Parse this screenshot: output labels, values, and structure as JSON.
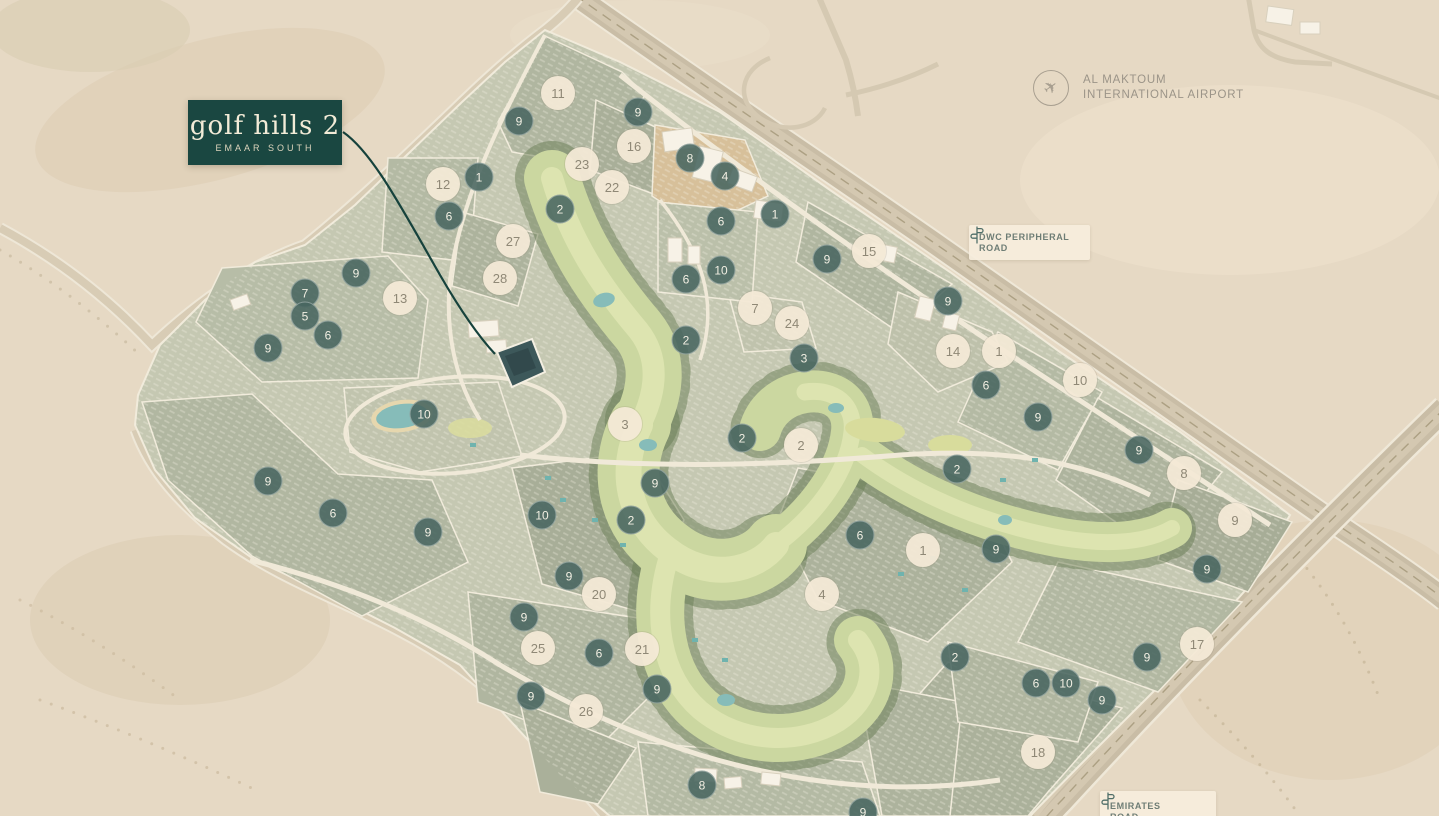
{
  "project_badge": {
    "title": "golf hills 2",
    "subtitle": "EMAAR SOUTH"
  },
  "map_labels": {
    "airport": {
      "icon": "airplane-icon",
      "line1": "AL MAKTOUM",
      "line2": "INTERNATIONAL AIRPORT"
    },
    "dwc_road": {
      "icon": "signpost-icon",
      "line1": "DWC PERIPHERAL",
      "line2": "ROAD"
    },
    "emirates_road": {
      "icon": "signpost-icon",
      "line1": "EMIRATES",
      "line2": "ROAD"
    }
  },
  "colors": {
    "badge_bg": "#1a4741",
    "badge_text": "#f2ebd7",
    "marker_dark_bg": "#486560",
    "marker_dark_text": "#f2efe3",
    "marker_light_bg": "#f3e9d6",
    "marker_light_text": "#8f8876",
    "highlight_plot": "#3d585a",
    "leader_line": "#16423c",
    "desert": "#e6d9c4",
    "development": "#c5c8b2",
    "golf_green": "#cbd7a0",
    "water": "#86bcb9",
    "road": "#c9bda6"
  },
  "markers": {
    "items": [
      {
        "n": "9",
        "x": 519,
        "y": 121,
        "variant": "dark"
      },
      {
        "n": "9",
        "x": 638,
        "y": 112,
        "variant": "dark"
      },
      {
        "n": "8",
        "x": 690,
        "y": 158,
        "variant": "dark"
      },
      {
        "n": "4",
        "x": 725,
        "y": 176,
        "variant": "dark"
      },
      {
        "n": "1",
        "x": 479,
        "y": 177,
        "variant": "dark"
      },
      {
        "n": "2",
        "x": 560,
        "y": 209,
        "variant": "dark"
      },
      {
        "n": "1",
        "x": 775,
        "y": 214,
        "variant": "dark"
      },
      {
        "n": "6",
        "x": 449,
        "y": 216,
        "variant": "dark"
      },
      {
        "n": "6",
        "x": 721,
        "y": 221,
        "variant": "dark"
      },
      {
        "n": "9",
        "x": 827,
        "y": 259,
        "variant": "dark"
      },
      {
        "n": "10",
        "x": 721,
        "y": 270,
        "variant": "dark"
      },
      {
        "n": "9",
        "x": 356,
        "y": 273,
        "variant": "dark"
      },
      {
        "n": "6",
        "x": 686,
        "y": 279,
        "variant": "dark"
      },
      {
        "n": "7",
        "x": 305,
        "y": 293,
        "variant": "dark"
      },
      {
        "n": "9",
        "x": 948,
        "y": 301,
        "variant": "dark"
      },
      {
        "n": "5",
        "x": 305,
        "y": 316,
        "variant": "dark"
      },
      {
        "n": "6",
        "x": 328,
        "y": 335,
        "variant": "dark"
      },
      {
        "n": "2",
        "x": 686,
        "y": 340,
        "variant": "dark"
      },
      {
        "n": "9",
        "x": 268,
        "y": 348,
        "variant": "dark"
      },
      {
        "n": "3",
        "x": 804,
        "y": 358,
        "variant": "dark"
      },
      {
        "n": "6",
        "x": 986,
        "y": 385,
        "variant": "dark"
      },
      {
        "n": "10",
        "x": 424,
        "y": 414,
        "variant": "dark"
      },
      {
        "n": "9",
        "x": 1038,
        "y": 417,
        "variant": "dark"
      },
      {
        "n": "2",
        "x": 742,
        "y": 438,
        "variant": "dark"
      },
      {
        "n": "9",
        "x": 1139,
        "y": 450,
        "variant": "dark"
      },
      {
        "n": "2",
        "x": 957,
        "y": 469,
        "variant": "dark"
      },
      {
        "n": "9",
        "x": 268,
        "y": 481,
        "variant": "dark"
      },
      {
        "n": "9",
        "x": 655,
        "y": 483,
        "variant": "dark"
      },
      {
        "n": "6",
        "x": 333,
        "y": 513,
        "variant": "dark"
      },
      {
        "n": "10",
        "x": 542,
        "y": 515,
        "variant": "dark"
      },
      {
        "n": "2",
        "x": 631,
        "y": 520,
        "variant": "dark"
      },
      {
        "n": "9",
        "x": 428,
        "y": 532,
        "variant": "dark"
      },
      {
        "n": "6",
        "x": 860,
        "y": 535,
        "variant": "dark"
      },
      {
        "n": "9",
        "x": 996,
        "y": 549,
        "variant": "dark"
      },
      {
        "n": "9",
        "x": 1207,
        "y": 569,
        "variant": "dark"
      },
      {
        "n": "9",
        "x": 569,
        "y": 576,
        "variant": "dark"
      },
      {
        "n": "9",
        "x": 524,
        "y": 617,
        "variant": "dark"
      },
      {
        "n": "6",
        "x": 599,
        "y": 653,
        "variant": "dark"
      },
      {
        "n": "2",
        "x": 955,
        "y": 657,
        "variant": "dark"
      },
      {
        "n": "9",
        "x": 1147,
        "y": 657,
        "variant": "dark"
      },
      {
        "n": "6",
        "x": 1036,
        "y": 683,
        "variant": "dark"
      },
      {
        "n": "10",
        "x": 1066,
        "y": 683,
        "variant": "dark"
      },
      {
        "n": "9",
        "x": 657,
        "y": 689,
        "variant": "dark"
      },
      {
        "n": "9",
        "x": 531,
        "y": 696,
        "variant": "dark"
      },
      {
        "n": "9",
        "x": 1102,
        "y": 700,
        "variant": "dark"
      },
      {
        "n": "8",
        "x": 702,
        "y": 785,
        "variant": "dark"
      },
      {
        "n": "9",
        "x": 863,
        "y": 812,
        "variant": "dark"
      },
      {
        "n": "11",
        "x": 558,
        "y": 93,
        "variant": "light"
      },
      {
        "n": "16",
        "x": 634,
        "y": 146,
        "variant": "light"
      },
      {
        "n": "23",
        "x": 582,
        "y": 164,
        "variant": "light"
      },
      {
        "n": "12",
        "x": 443,
        "y": 184,
        "variant": "light"
      },
      {
        "n": "22",
        "x": 612,
        "y": 187,
        "variant": "light"
      },
      {
        "n": "27",
        "x": 513,
        "y": 241,
        "variant": "light"
      },
      {
        "n": "15",
        "x": 869,
        "y": 251,
        "variant": "light"
      },
      {
        "n": "28",
        "x": 500,
        "y": 278,
        "variant": "light"
      },
      {
        "n": "13",
        "x": 400,
        "y": 298,
        "variant": "light"
      },
      {
        "n": "7",
        "x": 755,
        "y": 308,
        "variant": "light"
      },
      {
        "n": "24",
        "x": 792,
        "y": 323,
        "variant": "light"
      },
      {
        "n": "14",
        "x": 953,
        "y": 351,
        "variant": "light"
      },
      {
        "n": "1",
        "x": 999,
        "y": 351,
        "variant": "light"
      },
      {
        "n": "10",
        "x": 1080,
        "y": 380,
        "variant": "light"
      },
      {
        "n": "3",
        "x": 625,
        "y": 424,
        "variant": "light"
      },
      {
        "n": "2",
        "x": 801,
        "y": 445,
        "variant": "light"
      },
      {
        "n": "8",
        "x": 1184,
        "y": 473,
        "variant": "light"
      },
      {
        "n": "9",
        "x": 1235,
        "y": 520,
        "variant": "light"
      },
      {
        "n": "1",
        "x": 923,
        "y": 550,
        "variant": "light"
      },
      {
        "n": "4",
        "x": 822,
        "y": 594,
        "variant": "light"
      },
      {
        "n": "20",
        "x": 599,
        "y": 594,
        "variant": "light"
      },
      {
        "n": "17",
        "x": 1197,
        "y": 644,
        "variant": "light"
      },
      {
        "n": "25",
        "x": 538,
        "y": 648,
        "variant": "light"
      },
      {
        "n": "21",
        "x": 642,
        "y": 649,
        "variant": "light"
      },
      {
        "n": "26",
        "x": 586,
        "y": 711,
        "variant": "light"
      },
      {
        "n": "18",
        "x": 1038,
        "y": 752,
        "variant": "light"
      }
    ]
  }
}
